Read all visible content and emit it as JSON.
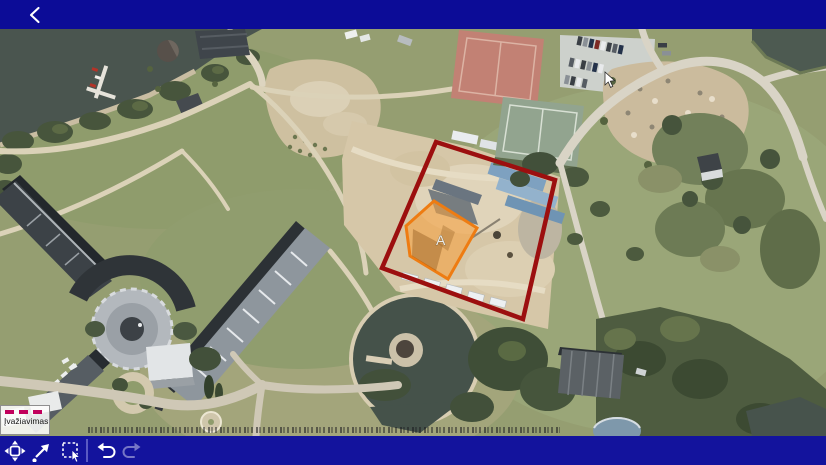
{
  "screen": {
    "width_px": 826,
    "height_px": 465
  },
  "top_bar": {
    "color": "#0c0c97",
    "icons": [
      "back-chevron-icon"
    ]
  },
  "map": {
    "content": "aerial orthophoto: lake and piers (top-left), large resort building complex with round plaza (center-left), circular pond with island (bottom-center), tennis courts and car parking (top-right), gravel mound, construction site outlined in red with orange building footprint labeled A",
    "legend": {
      "label": "Įvažiavimas",
      "swatch_style": "dashed-line",
      "swatch_color": "#c1005c"
    },
    "overlays": {
      "site_boundary": {
        "shape": "polygon",
        "stroke": "#9c0f0f",
        "stroke_width": 4.5,
        "points": "436,113 555,151 523,290 382,239"
      },
      "building_a": {
        "shape": "polygon",
        "label": "A",
        "stroke": "#ee7c12",
        "fill": "#f5a142",
        "fill_opacity": 0.6,
        "points": "434,172 477,199 448,250 410,227 406,197"
      }
    },
    "cursor": {
      "type": "mouse-pointer",
      "x": 605,
      "y": 72
    }
  },
  "toolbar": {
    "color": "#13139d",
    "tools": [
      {
        "id": "pan",
        "icon": "pan-move-icon",
        "enabled": true
      },
      {
        "id": "draw-arrow",
        "icon": "arrow-northeast-icon",
        "enabled": true
      },
      {
        "id": "marquee-select",
        "icon": "marquee-select-icon",
        "enabled": true
      },
      {
        "id": "undo",
        "icon": "undo-arrow-icon",
        "enabled": true
      },
      {
        "id": "redo",
        "icon": "redo-arrow-icon",
        "enabled": false
      }
    ]
  }
}
